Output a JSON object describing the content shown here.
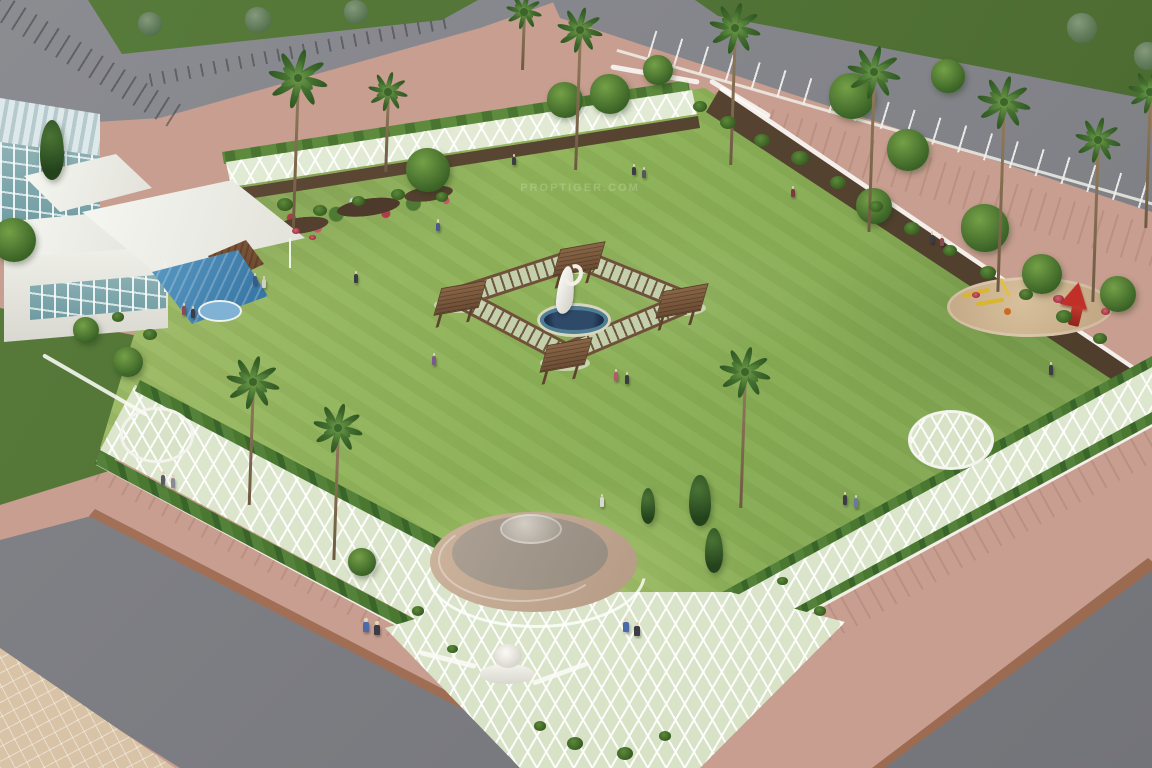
{
  "scene": {
    "watermark": "PROPTIGER.COM"
  },
  "palette": {
    "lawn": "#8db257",
    "tile": "#d7e2c6",
    "tile_line": "rgba(255,255,255,0.92)",
    "hedge": "#46722f",
    "road": "#84858a",
    "pavement_pink": "#c79e90",
    "pavement_tan": "#d9c3a6",
    "brick_edge": "#9a6a50",
    "wood": "#7d5b3f",
    "pool": "#2e6c9c",
    "pond": "#1c2e4a",
    "sand": "#c4a986",
    "red": "#c03028",
    "yellow": "#d9b62c",
    "glass": "#8fb3b6",
    "sculpt": "#cfccc0"
  },
  "scenery": {
    "palms": [
      [
        298,
        78,
        228,
        1.15
      ],
      [
        388,
        92,
        172,
        0.75
      ],
      [
        524,
        12,
        70,
        0.7
      ],
      [
        580,
        30,
        170,
        0.9
      ],
      [
        735,
        28,
        165,
        1.0
      ],
      [
        874,
        72,
        232,
        1.05
      ],
      [
        1004,
        102,
        292,
        1.05
      ],
      [
        1098,
        140,
        302,
        0.9
      ],
      [
        1150,
        92,
        228,
        0.85
      ],
      [
        253,
        382,
        505,
        1.05
      ],
      [
        338,
        428,
        560,
        0.95
      ],
      [
        745,
        372,
        508,
        1.0
      ]
    ],
    "trees": [
      [
        52,
        150,
        40,
        "conifer"
      ],
      [
        14,
        240,
        44,
        "round"
      ],
      [
        86,
        330,
        26,
        "round"
      ],
      [
        128,
        362,
        30,
        "round"
      ],
      [
        428,
        170,
        44,
        "round"
      ],
      [
        565,
        100,
        36,
        "round"
      ],
      [
        610,
        94,
        40,
        "round"
      ],
      [
        658,
        70,
        30,
        "round"
      ],
      [
        852,
        96,
        46,
        "round"
      ],
      [
        908,
        150,
        42,
        "round"
      ],
      [
        948,
        76,
        34,
        "round"
      ],
      [
        874,
        206,
        36,
        "round"
      ],
      [
        985,
        228,
        48,
        "round"
      ],
      [
        1042,
        274,
        40,
        "round"
      ],
      [
        1118,
        294,
        36,
        "round"
      ],
      [
        700,
        500,
        34,
        "conifer"
      ],
      [
        714,
        550,
        30,
        "conifer"
      ],
      [
        648,
        506,
        24,
        "conifer"
      ],
      [
        362,
        562,
        28,
        "round"
      ],
      [
        150,
        24,
        24,
        "muted"
      ],
      [
        258,
        20,
        26,
        "muted"
      ],
      [
        356,
        12,
        24,
        "muted"
      ],
      [
        1082,
        28,
        30,
        "muted"
      ],
      [
        1148,
        56,
        28,
        "muted"
      ]
    ],
    "bushes": [
      [
        700,
        108,
        14,
        "green"
      ],
      [
        728,
        124,
        16,
        "green"
      ],
      [
        762,
        142,
        16,
        "green"
      ],
      [
        800,
        160,
        18,
        "green"
      ],
      [
        838,
        184,
        16,
        "green"
      ],
      [
        876,
        208,
        14,
        "green"
      ],
      [
        912,
        230,
        16,
        "green"
      ],
      [
        950,
        252,
        14,
        "green"
      ],
      [
        988,
        274,
        16,
        "green"
      ],
      [
        1026,
        296,
        14,
        "green"
      ],
      [
        1064,
        318,
        16,
        "green"
      ],
      [
        1100,
        340,
        14,
        "green"
      ],
      [
        285,
        206,
        16,
        "green"
      ],
      [
        320,
        212,
        14,
        "green"
      ],
      [
        358,
        202,
        13,
        "green"
      ],
      [
        398,
        196,
        14,
        "green"
      ],
      [
        442,
        198,
        12,
        "green"
      ],
      [
        150,
        336,
        14,
        "green"
      ],
      [
        118,
        318,
        12,
        "green"
      ],
      [
        418,
        612,
        12,
        "green"
      ],
      [
        452,
        650,
        11,
        "green"
      ],
      [
        820,
        612,
        12,
        "green"
      ],
      [
        782,
        582,
        11,
        "green"
      ],
      [
        575,
        745,
        16,
        "green"
      ],
      [
        625,
        755,
        16,
        "green"
      ],
      [
        540,
        727,
        12,
        "green"
      ],
      [
        665,
        737,
        12,
        "green"
      ],
      [
        1058,
        300,
        11,
        "red"
      ],
      [
        1105,
        312,
        9,
        "red"
      ],
      [
        296,
        232,
        8,
        "red"
      ],
      [
        312,
        238,
        7,
        "red"
      ],
      [
        976,
        296,
        8,
        "red"
      ]
    ],
    "people": [
      [
        514,
        168,
        "#3c3c46",
        0.9
      ],
      [
        634,
        178,
        "#3c3c46",
        0.9
      ],
      [
        644,
        181,
        "#55555f",
        0.9
      ],
      [
        438,
        234,
        "#4a5a8a",
        0.95
      ],
      [
        356,
        286,
        "#3c3c46",
        1
      ],
      [
        184,
        318,
        "#8a4a52",
        1
      ],
      [
        193,
        321,
        "#3c3c46",
        1
      ],
      [
        255,
        288,
        "#3a5a88",
        1
      ],
      [
        264,
        291,
        "#d0d0c8",
        1
      ],
      [
        434,
        368,
        "#7a5a8a",
        1
      ],
      [
        616,
        384,
        "#b05a6a",
        1
      ],
      [
        627,
        387,
        "#3c3c46",
        1
      ],
      [
        602,
        510,
        "#d8d8d2",
        1.05
      ],
      [
        845,
        508,
        "#3c3c46",
        1.05
      ],
      [
        856,
        511,
        "#6a7a9a",
        1.05
      ],
      [
        163,
        488,
        "#5a5a64",
        1.1
      ],
      [
        173,
        491,
        "#8a8a92",
        1.1
      ],
      [
        366,
        636,
        "#4a6aaa",
        1.2
      ],
      [
        377,
        639,
        "#3c3c46",
        1.2
      ],
      [
        626,
        636,
        "#4a6aaa",
        1.2
      ],
      [
        637,
        640,
        "#3c3c46",
        1.2
      ],
      [
        932,
        246,
        "#3c3c46",
        0.95
      ],
      [
        942,
        249,
        "#8a4a52",
        0.95
      ],
      [
        1051,
        378,
        "#3c3c46",
        1.05
      ],
      [
        793,
        200,
        "#7a3a42",
        0.9
      ]
    ]
  }
}
